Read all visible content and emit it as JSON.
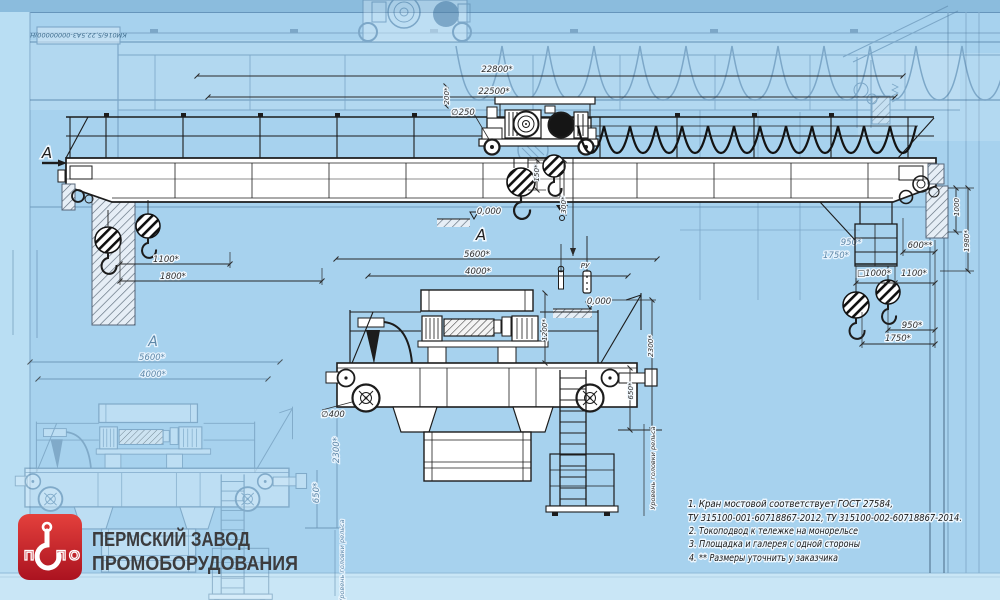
{
  "brand": {
    "letters": [
      "П",
      "П",
      "О"
    ],
    "company_line1": "ПЕРМСКИЙ ЗАВОД",
    "company_line2": "ПРОМОБОРУДОВАНИЯ",
    "logo_red": "#d6232a",
    "text_color": "#3c3c3e"
  },
  "title_block": {
    "designation": "КМ016/5,22,5А3-00000000/Н"
  },
  "notes": {
    "n1": "1. Кран мостовой соответствует ГОСТ 27584,",
    "n1b": "ТУ 315100-001-60718867-2012,  ТУ 315100-002-60718867-2014.",
    "n2": "2. Токоподвод к тележке на монорельсе",
    "n3": "3. Площадка и галерея с одной стороны",
    "n4": "4.  ** Размеры уточнить у заказчика"
  },
  "labels": {
    "section": "А",
    "view": "А",
    "zero_main": "0,000",
    "zero_end": "0,000",
    "pendant": "РУ",
    "rail_level": "Уровень головки рельса"
  },
  "dims": {
    "span_building": "22800*",
    "span_crane": "22500*",
    "trolley_wheel_dia": "∅250",
    "top_gap": "200*",
    "hook_main_h": "150*",
    "hook_aux_h": "300*",
    "left_hook_1": "1100*",
    "left_hook_2": "1800*",
    "base_1": "5600*",
    "base_2": "4000*",
    "right_wall": "600**",
    "right_col": "1000",
    "right_height": "1980*",
    "platform_w": "□1000*",
    "right_gap": "1100*",
    "right_hook_1": "950*",
    "right_hook_2": "1750*",
    "hoist_height": "1200*",
    "bridge_height": "2300*",
    "girder_height": "650*",
    "wheel_dia": "∅400"
  },
  "ghost": {
    "view": "А",
    "base_1": "5600*",
    "base_2": "4000*",
    "bridge_height": "2300*",
    "girder_height": "650*",
    "rail_level": "Уровень головки рельса",
    "hook_1": "950*",
    "hook_2": "1750*"
  },
  "colors": {
    "background": "#a7d2ee",
    "ink": "#1c1c1c",
    "faded_ink": "#527ea3"
  }
}
